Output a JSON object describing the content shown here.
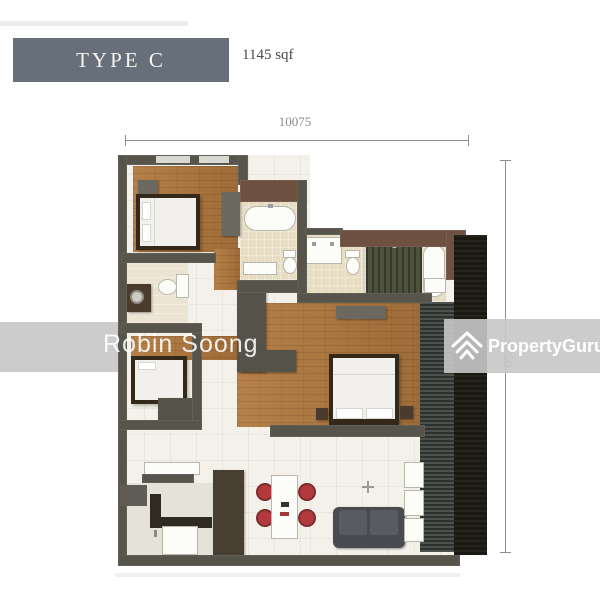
{
  "header": {
    "type_label": "TYPE C",
    "area_label": "1145 sqf"
  },
  "dimensions": {
    "top": "10075",
    "right": "9750"
  },
  "watermarks": {
    "name": "Robin Soong",
    "brand": "PropertyGuru"
  },
  "icons": {
    "brand_mark": "propertyguru-chevron-icon"
  },
  "colors": {
    "type_box": "#67707a",
    "wall_gray": "#56544b",
    "wall_brown": "#6e5140",
    "wall_black": "#191912",
    "wood_floor": "#b07c45",
    "bath_tile": "#e7ddc3",
    "accent_chair_red": "#b23a3e",
    "watermark_gray": "#c7c7c7"
  }
}
